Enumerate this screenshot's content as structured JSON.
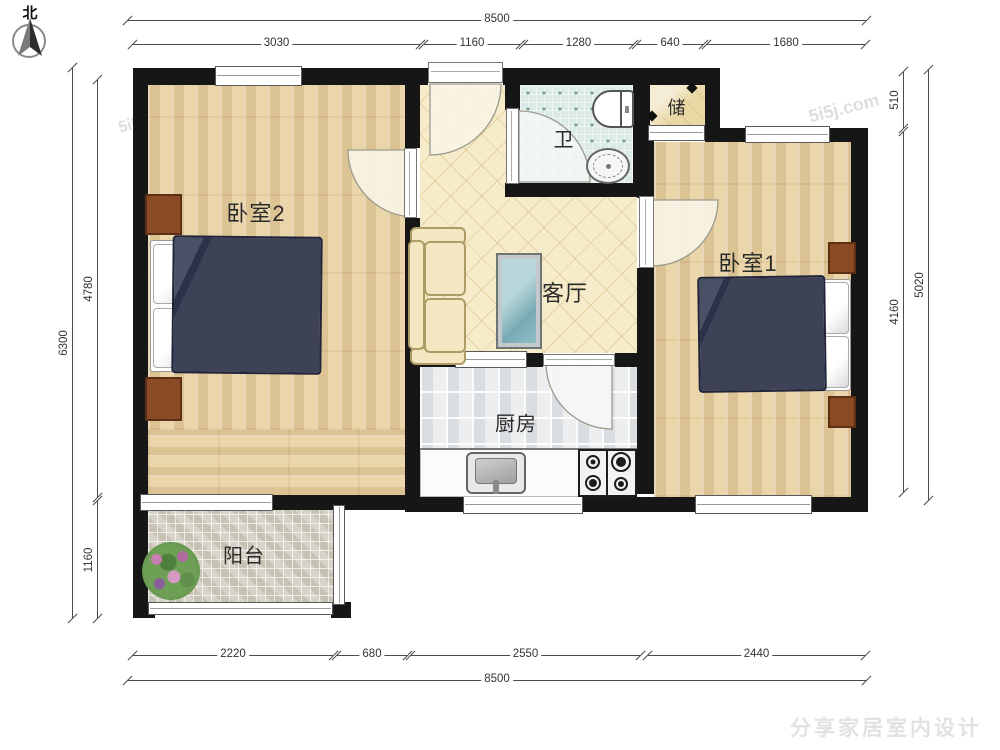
{
  "compass": {
    "label": "北"
  },
  "rooms": {
    "bedroom2": {
      "label": "卧室2"
    },
    "bedroom1": {
      "label": "卧室1"
    },
    "living": {
      "label": "客厅"
    },
    "kitchen": {
      "label": "厨房"
    },
    "bathroom": {
      "label": "卫"
    },
    "storage": {
      "label": "储"
    },
    "balcony": {
      "label": "阳台"
    }
  },
  "dimensions": {
    "top_total": "8500",
    "top_segments": [
      "3030",
      "1160",
      "1280",
      "640",
      "1680"
    ],
    "left_total": "6300",
    "left_segments": [
      "4780",
      "1160"
    ],
    "right_total": "5020",
    "right_segments": [
      "510",
      "4160"
    ],
    "bottom_segments": [
      "2220",
      "680",
      "2550",
      "2440"
    ],
    "bottom_total": "8500"
  },
  "watermarks": {
    "brand": "5i5j.com",
    "footer": "分享家居室内设计"
  },
  "colors": {
    "wall": "#161616",
    "wood_floor": "#ead5a9",
    "hall_tile": "#f6ecca",
    "bath_tile": "#dcebe7",
    "kitchen_tile": "#eceef0",
    "balcony_tile": "#d8d3c8",
    "duvet_navy": "#3d4257",
    "nightstand_brown": "#8a4a26"
  }
}
